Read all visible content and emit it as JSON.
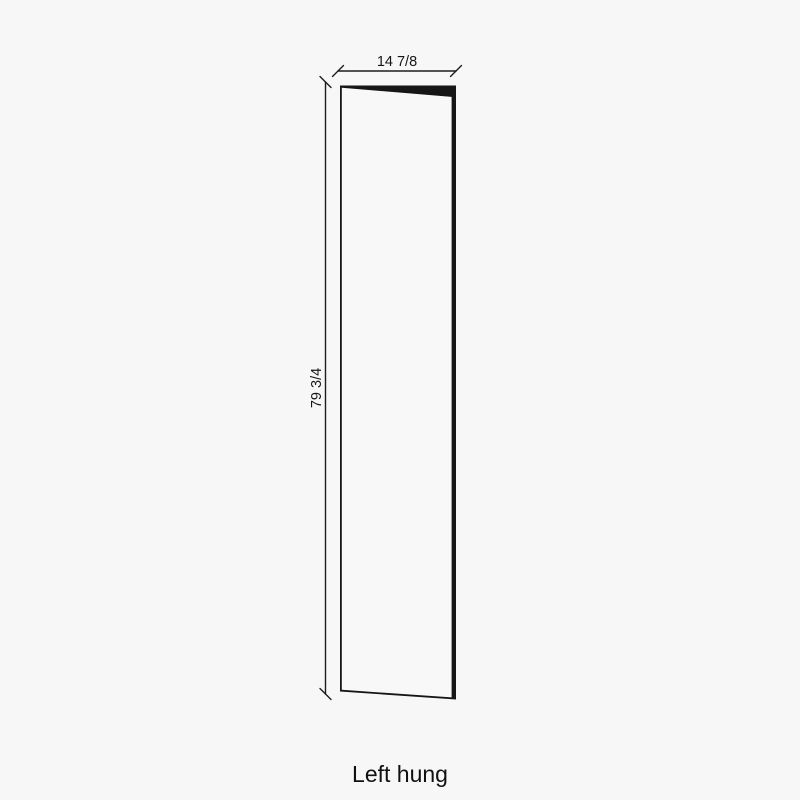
{
  "colors": {
    "background": "#f7f7f8",
    "ink": "#161616"
  },
  "diagram": {
    "width_label": "14 7/8",
    "height_label": "79 3/4",
    "caption": "Left hung"
  }
}
